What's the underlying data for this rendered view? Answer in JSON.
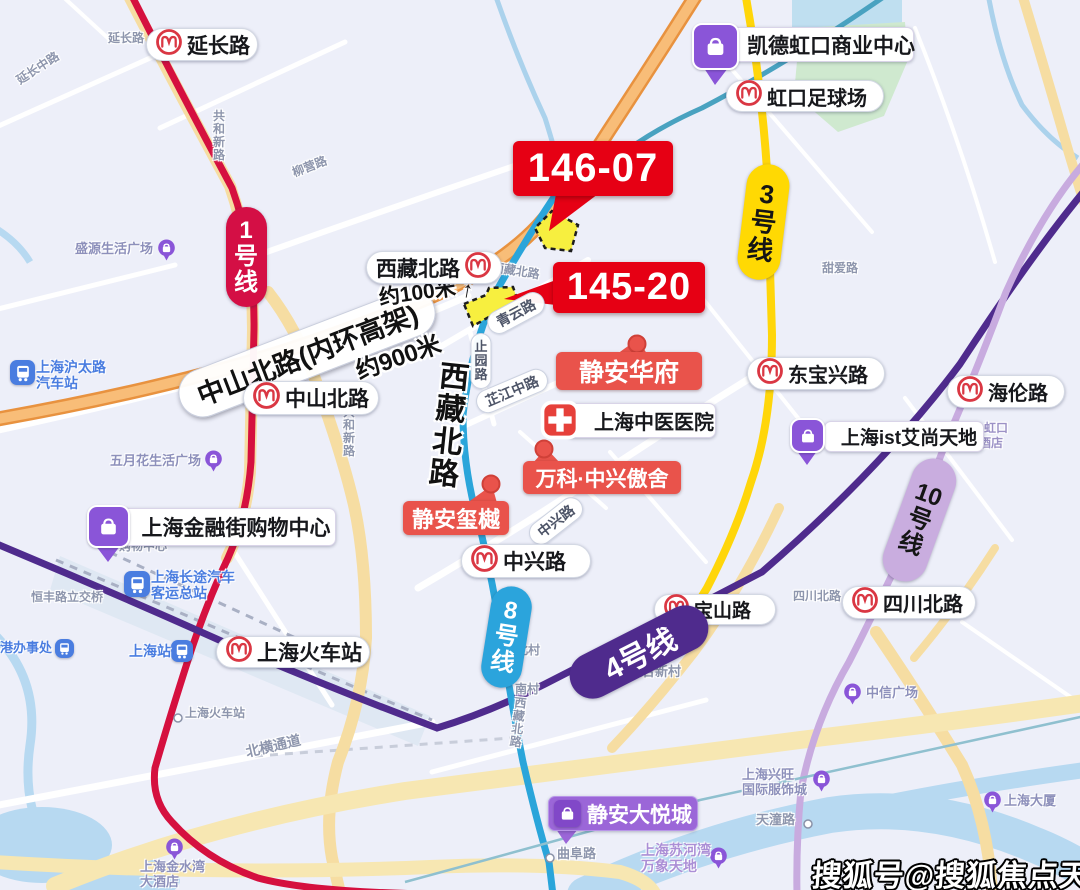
{
  "meta": {
    "watermark": "搜狐号@搜狐焦点天门站"
  },
  "colors": {
    "banner_red": "#e60014",
    "project_red": "#e9534b",
    "plot_yellow": "#f7ef3f",
    "line1": "#d5103f",
    "line3": "#ffd903",
    "line4": "#4f2b8d",
    "line8": "#2aa5da",
    "line10": "#c8abdf",
    "poi_purple": "#8a55d8",
    "transit_blue": "#4a7de0"
  },
  "banners": [
    {
      "label": "146-07",
      "x": 513,
      "y": 141,
      "w": 160,
      "h": 55,
      "fs": 40
    },
    {
      "label": "145-20",
      "x": 553,
      "y": 262,
      "w": 152,
      "h": 51,
      "fs": 38
    }
  ],
  "stations": [
    {
      "label": "延长路",
      "x": 146,
      "y": 28,
      "w": 112,
      "h": 33,
      "fs": 21
    },
    {
      "label": "虹口足球场",
      "x": 726,
      "y": 80,
      "w": 158,
      "h": 32,
      "fs": 20
    },
    {
      "label": "西藏北路",
      "x": 366,
      "y": 251,
      "w": 136,
      "h": 33,
      "fs": 21,
      "iconSide": "right"
    },
    {
      "label": "中山北路",
      "x": 243,
      "y": 381,
      "w": 136,
      "h": 34,
      "fs": 21
    },
    {
      "label": "东宝兴路",
      "x": 747,
      "y": 357,
      "w": 138,
      "h": 33,
      "fs": 20
    },
    {
      "label": "海伦路",
      "x": 947,
      "y": 375,
      "w": 118,
      "h": 33,
      "fs": 20
    },
    {
      "label": "上海火车站",
      "x": 216,
      "y": 636,
      "w": 154,
      "h": 32,
      "fs": 21
    },
    {
      "label": "中兴路",
      "x": 461,
      "y": 544,
      "w": 130,
      "h": 34,
      "fs": 21
    },
    {
      "label": "宝山路",
      "x": 654,
      "y": 594,
      "w": 122,
      "h": 31,
      "fs": 19
    },
    {
      "label": "四川北路",
      "x": 842,
      "y": 586,
      "w": 134,
      "h": 33,
      "fs": 20
    }
  ],
  "line_badges": [
    {
      "label": "1号线",
      "cx": 246,
      "cy": 257,
      "w": 41,
      "h": 100,
      "rot": 0,
      "bg": "#d40f45",
      "fg": "#ffffff",
      "fs": 24,
      "vertical": true
    },
    {
      "label": "3号线",
      "cx": 763,
      "cy": 222,
      "w": 43,
      "h": 116,
      "rot": 7,
      "bg": "#ffd903",
      "fg": "#151515",
      "fs": 26,
      "vertical": true
    },
    {
      "label": "8号线",
      "cx": 506,
      "cy": 637,
      "w": 41,
      "h": 102,
      "rot": 9,
      "bg": "#2ba4dc",
      "fg": "#ffffff",
      "fs": 24,
      "vertical": true
    },
    {
      "label": "4号线",
      "cx": 639,
      "cy": 652,
      "w": 150,
      "h": 46,
      "rot": -27,
      "bg": "#4f2b8d",
      "fg": "#ffffff",
      "fs": 30,
      "vertical": false
    },
    {
      "label": "10号线",
      "cx": 919,
      "cy": 520,
      "w": 45,
      "h": 128,
      "rot": 20,
      "bg": "#c9addf",
      "fg": "#151515",
      "fs": 24,
      "vertical": true
    }
  ],
  "projects": [
    {
      "label": "静安华府",
      "x": 556,
      "y": 352,
      "w": 146,
      "h": 38,
      "fs": 25
    },
    {
      "label": "万科·中兴傲舍",
      "x": 523,
      "y": 461,
      "w": 158,
      "h": 33,
      "fs": 21
    },
    {
      "label": "静安玺樾",
      "x": 403,
      "y": 501,
      "w": 106,
      "h": 34,
      "fs": 22
    }
  ],
  "white_pois": [
    {
      "label": "上海中医医院",
      "x": 566,
      "y": 403,
      "w": 150,
      "h": 35,
      "fs": 20,
      "icon": "cross",
      "ix": 540,
      "iy": 400,
      "is": 40,
      "pad": 26
    },
    {
      "label": "凯德虹口商业中心",
      "x": 714,
      "y": 27,
      "w": 200,
      "h": 35,
      "fs": 21,
      "icon": "bag",
      "ix": 692,
      "iy": 23,
      "is": 47,
      "pad": 34
    },
    {
      "label": "上海ist艾尚天地",
      "x": 824,
      "y": 421,
      "w": 160,
      "h": 31,
      "fs": 19,
      "icon": "bag",
      "ix": 790,
      "iy": 418,
      "is": 35,
      "pad": 10
    },
    {
      "label": "上海金融街购物中心",
      "x": 120,
      "y": 508,
      "w": 216,
      "h": 38,
      "fs": 21,
      "icon": "bag",
      "ix": 87,
      "iy": 505,
      "is": 43,
      "pad": 16
    },
    {
      "label": "静安大悦城",
      "x": 548,
      "y": 796,
      "w": 150,
      "h": 35,
      "fs": 21,
      "style": "purple"
    }
  ],
  "transit_pois": [
    {
      "lines": [
        "上海沪太路",
        "汽车站"
      ],
      "tx": 36,
      "ty": 359,
      "fs": 14,
      "ix": 10,
      "iy": 360,
      "is": 25
    },
    {
      "lines": [
        "上海长途汽车",
        "客运总站"
      ],
      "tx": 151,
      "ty": 569,
      "fs": 14,
      "ix": 124,
      "iy": 571,
      "is": 26
    },
    {
      "lines": [
        "上海站"
      ],
      "tx": 129,
      "ty": 643,
      "fs": 14,
      "ix": 171,
      "iy": 640,
      "is": 22
    },
    {
      "lines": [
        "港办事处"
      ],
      "tx": 0,
      "ty": 641,
      "fs": 13,
      "ix": 55,
      "iy": 639,
      "is": 19
    }
  ],
  "purple_pois": [
    {
      "lines": [
        "盛源生活广场"
      ],
      "tx": 75,
      "ty": 242,
      "fs": 13,
      "px": 156,
      "py": 238,
      "ps": 21
    },
    {
      "lines": [
        "五月花生活广场"
      ],
      "tx": 110,
      "ty": 454,
      "fs": 13,
      "px": 203,
      "py": 449,
      "ps": 21
    },
    {
      "lines": [
        "中信广场"
      ],
      "tx": 866,
      "ty": 686,
      "fs": 13,
      "px": 842,
      "py": 682,
      "ps": 21
    },
    {
      "lines": [
        "上海兴旺",
        "国际服饰城"
      ],
      "tx": 742,
      "ty": 768,
      "fs": 13,
      "px": 811,
      "py": 769,
      "ps": 21
    },
    {
      "lines": [
        "上海大厦"
      ],
      "tx": 1004,
      "ty": 794,
      "fs": 13,
      "px": 982,
      "py": 790,
      "ps": 21
    },
    {
      "lines": [
        "上海苏河湾",
        "万象天地"
      ],
      "tx": 641,
      "ty": 842,
      "fs": 14,
      "px": 708,
      "py": 846,
      "ps": 21,
      "color": "#ab8fd6"
    },
    {
      "lines": [
        "上海金水湾",
        "大酒店"
      ],
      "tx": 140,
      "ty": 860,
      "fs": 13,
      "px": 164,
      "py": 837,
      "ps": 21
    }
  ],
  "map_texts": [
    {
      "text": "延长路",
      "x": 108,
      "y": 32,
      "fs": 12
    },
    {
      "text": "延长中路",
      "x": 18,
      "y": 75,
      "fs": 12,
      "rot": -33
    },
    {
      "text": "柳营路",
      "x": 293,
      "y": 167,
      "fs": 12,
      "rot": -21
    },
    {
      "text": "共和新路",
      "x": 213,
      "y": 110,
      "fs": 12,
      "vertical": true
    },
    {
      "text": "甜爱路",
      "x": 822,
      "y": 262,
      "fs": 12
    },
    {
      "text": "西藏北路",
      "x": 492,
      "y": 261,
      "fs": 12,
      "rot": 9
    },
    {
      "text": "共和新路",
      "x": 343,
      "y": 406,
      "fs": 12,
      "vertical": true
    },
    {
      "text": "联合新村",
      "x": 629,
      "y": 665,
      "fs": 13
    },
    {
      "text": "北村",
      "x": 516,
      "y": 644,
      "fs": 12
    },
    {
      "text": "南村",
      "x": 515,
      "y": 683,
      "fs": 12
    },
    {
      "text": "西藏北路",
      "x": 512,
      "y": 697,
      "fs": 12,
      "vertical": true,
      "rot": 7
    },
    {
      "text": "上海火车站",
      "x": 185,
      "y": 707,
      "fs": 12,
      "ring": [
        172,
        711
      ]
    },
    {
      "text": "北横通道",
      "x": 246,
      "y": 745,
      "fs": 14,
      "rot": -13
    },
    {
      "text": "恒丰路立交桥",
      "x": 31,
      "y": 591,
      "fs": 12
    },
    {
      "text": "购物中心",
      "x": 119,
      "y": 540,
      "fs": 12
    },
    {
      "text": "曲阜路",
      "x": 557,
      "y": 847,
      "fs": 13,
      "ring": [
        544,
        851
      ]
    },
    {
      "text": "天潼路",
      "x": 756,
      "y": 813,
      "fs": 13,
      "ring": [
        802,
        817
      ]
    },
    {
      "text": "四川北路",
      "x": 793,
      "y": 590,
      "fs": 12
    },
    {
      "text": "虹口",
      "x": 984,
      "y": 422,
      "fs": 12,
      "color": "#9c92c6"
    },
    {
      "text": "酒店",
      "x": 979,
      "y": 437,
      "fs": 12,
      "color": "#9c92c6"
    }
  ],
  "road_pills": [
    {
      "text": "青云路",
      "cx": 516,
      "cy": 313,
      "rot": -28,
      "fs": 14
    },
    {
      "text": "止园路",
      "cx": 481,
      "cy": 361,
      "fs": 13,
      "vertical": true
    },
    {
      "text": "芷江中路",
      "cx": 512,
      "cy": 391,
      "rot": -23,
      "fs": 14
    },
    {
      "text": "中兴路",
      "cx": 556,
      "cy": 521,
      "rot": -38,
      "fs": 14
    },
    {
      "text": "中山北路(内环高架)",
      "cx": 307,
      "cy": 353,
      "rot": -21,
      "fs": 27,
      "big": true
    }
  ],
  "major_road": {
    "text": "西藏北路",
    "x": 434,
    "y": 362,
    "fs": 30,
    "rot": 6
  },
  "measures": [
    {
      "text": "约100米",
      "x": 379,
      "y": 282,
      "rot": -8,
      "fs": 21,
      "arrow": "↑",
      "ax": 462,
      "ay": 277,
      "afs": 22,
      "arot": 10
    },
    {
      "text": "约900米",
      "x": 356,
      "y": 352,
      "rot": -19,
      "fs": 24,
      "arrow": "←",
      "ax": 260,
      "ay": 364,
      "afs": 28,
      "arot": -14
    }
  ],
  "shapes": [
    {
      "name": "land-plot-146-07",
      "type": "poly",
      "pts": "552,211 578,225 571,251 545,248 535,228",
      "fill": "#f7ef3f",
      "stroke": "#1d1d1d",
      "dash": "5,4",
      "sw": 2.5,
      "inter": true
    },
    {
      "name": "land-plot-145-20",
      "type": "poly",
      "pts": "464,304 486,295 489,288 513,287 521,310 500,318 496,313 473,326",
      "fill": "#f7ef3f",
      "stroke": "#1d1d1d",
      "dash": "5,4",
      "sw": 2.5,
      "inter": true
    },
    {
      "name": "banner-tail-146-07",
      "type": "poly",
      "pts": "556,194 598,194 549,231",
      "fill": "#e60014"
    },
    {
      "name": "banner-tail-145-20",
      "type": "poly",
      "pts": "556,280 556,305 504,299",
      "fill": "#e60014"
    },
    {
      "name": "project-tail",
      "type": "poly",
      "pts": "617,354 647,354 638,339",
      "fill": "#e9534b"
    },
    {
      "name": "project-dot",
      "type": "circle",
      "cx": 637,
      "cy": 344,
      "r": 8.5,
      "fill": "#e9534b",
      "stroke": "#cf4038",
      "sw": 2
    },
    {
      "name": "project-tail",
      "type": "poly",
      "pts": "533,463 560,463 546,448",
      "fill": "#e9534b"
    },
    {
      "name": "project-dot",
      "type": "circle",
      "cx": 544,
      "cy": 449,
      "r": 8.5,
      "fill": "#e9534b",
      "stroke": "#cf4038",
      "sw": 2
    },
    {
      "name": "project-tail",
      "type": "poly",
      "pts": "467,503 497,503 492,485",
      "fill": "#e9534b"
    },
    {
      "name": "project-dot",
      "type": "circle",
      "cx": 491,
      "cy": 484,
      "r": 8.5,
      "fill": "#e9534b",
      "stroke": "#cf4038",
      "sw": 2
    },
    {
      "name": "poi-pointer-tail",
      "type": "poly",
      "pts": "704,68 728,68 715,85",
      "fill": "#8a55d8"
    },
    {
      "name": "poi-pointer-tail",
      "type": "poly",
      "pts": "797,451 817,451 807,465",
      "fill": "#8a55d8"
    },
    {
      "name": "poi-pointer-tail",
      "type": "poly",
      "pts": "96,546 120,546 108,562",
      "fill": "#8a55d8"
    },
    {
      "name": "poi-pointer-tail",
      "type": "poly",
      "pts": "556,829 578,829 566,844",
      "fill": "#9b66d8"
    }
  ]
}
